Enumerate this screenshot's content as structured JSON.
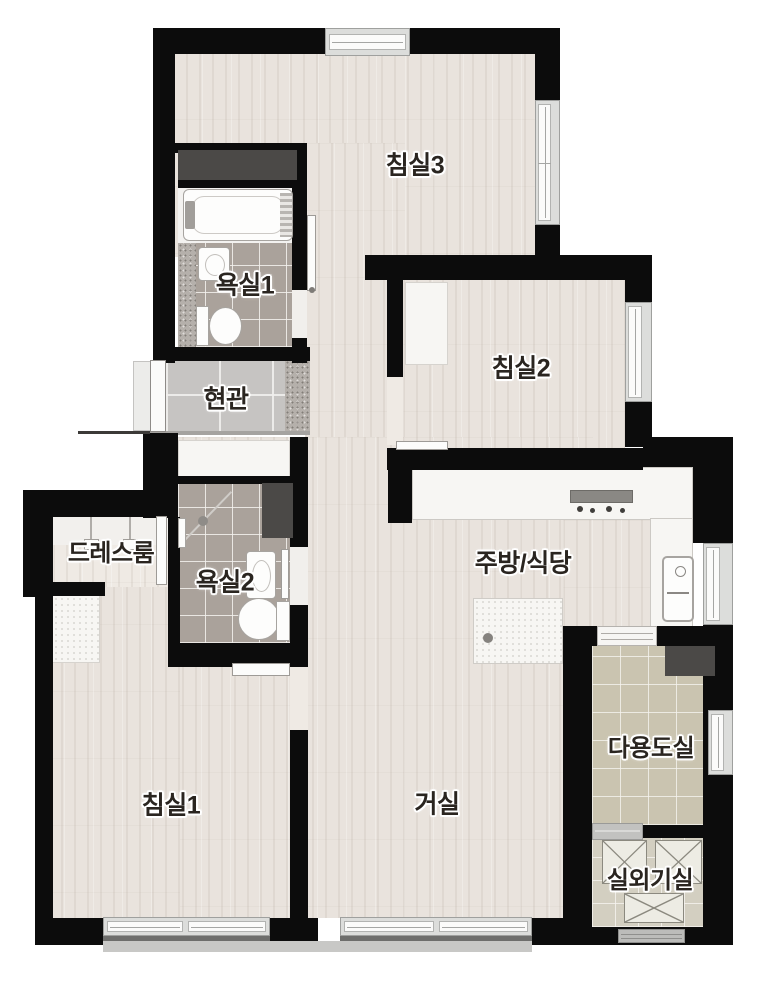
{
  "floorplan": {
    "type": "apartment-floor-plan",
    "language": "ko",
    "rooms": [
      {
        "id": "bedroom3",
        "label": "침실3"
      },
      {
        "id": "bathroom1",
        "label": "욕실1"
      },
      {
        "id": "entrance",
        "label": "현관"
      },
      {
        "id": "bedroom2",
        "label": "침실2"
      },
      {
        "id": "dressroom",
        "label": "드레스룸"
      },
      {
        "id": "bathroom2",
        "label": "욕실2"
      },
      {
        "id": "kitchen_dining",
        "label": "주방/식당"
      },
      {
        "id": "bedroom1",
        "label": "침실1"
      },
      {
        "id": "living_room",
        "label": "거실"
      },
      {
        "id": "utility_room",
        "label": "다용도실"
      },
      {
        "id": "outdoor_unit_room",
        "label": "실외기실"
      }
    ],
    "colors": {
      "wall": "#0c0c0c",
      "wood_floor": "#e9e3dd",
      "bathroom_tile": "#aaa29b",
      "entrance_tile": "#c6c4c2",
      "granite_tile": "#b5b0ab",
      "utility_tile": "#cac4b0",
      "outdoor_tile": "#d3cfc1",
      "counter_white": "#f7f6f3",
      "cabinet_dark": "#4b4947",
      "label_text": "#2a2520"
    }
  }
}
